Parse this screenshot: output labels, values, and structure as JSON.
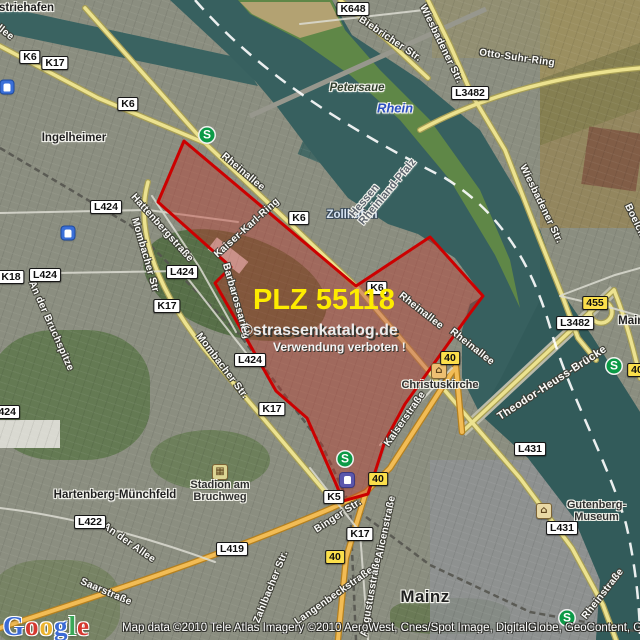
{
  "watermark": {
    "plz_label": "PLZ 55118",
    "brand": "©strassenkatalog.de",
    "warning": "Verwendung verboten !"
  },
  "attribution": {
    "logo_text": "Google",
    "logo_colors": [
      "#3b6ad4",
      "#d5382f",
      "#ecb32c",
      "#3b6ad4",
      "#3aa757",
      "#d5382f"
    ],
    "copyright": "Map data ©2010 Tele Atlas  Imagery ©2010 AeroWest, Cnes/Spot Image, DigitalGlobe, GeoContent, GeoEye"
  },
  "map": {
    "highlight": {
      "plz": "55118",
      "fill": "#be372d",
      "stroke": "#cc0000"
    },
    "colors": {
      "water": "#3a6361",
      "road_major": "#ece28f",
      "road_b": "#f2bc55",
      "island": "#5f8747"
    },
    "place_labels": [
      {
        "text": "ustriehafen",
        "x": 23,
        "y": 8,
        "cls": ""
      },
      {
        "text": "Ingelheimer",
        "x": 74,
        "y": 138,
        "cls": ""
      },
      {
        "text": "Petersaue",
        "x": 357,
        "y": 88,
        "cls": "ital"
      },
      {
        "text": "Rhein",
        "x": 395,
        "y": 108,
        "cls": "water"
      },
      {
        "text": "Zollhafen",
        "x": 352,
        "y": 215,
        "cls": "harbor"
      },
      {
        "text": "Hessen\nRheinland-Pfalz",
        "x": 383,
        "y": 188,
        "cls": "border",
        "rot": -50
      },
      {
        "text": "Hartenberg-Münchfeld",
        "x": 115,
        "y": 495,
        "cls": ""
      },
      {
        "text": "Mainz",
        "x": 425,
        "y": 597,
        "cls": "big"
      },
      {
        "text": "Mainz-",
        "x": 636,
        "y": 321,
        "cls": ""
      }
    ],
    "street_labels": [
      {
        "text": "allee",
        "x": 3,
        "y": 31,
        "rot": 38
      },
      {
        "text": "Rheinallee",
        "x": 243,
        "y": 172,
        "rot": 40
      },
      {
        "text": "Rheinallee",
        "x": 421,
        "y": 311,
        "rot": 38
      },
      {
        "text": "Rheinallee",
        "x": 472,
        "y": 347,
        "rot": 38
      },
      {
        "text": "Rheinstraße",
        "x": 603,
        "y": 594,
        "rot": -52
      },
      {
        "text": "Biebricher Str.",
        "x": 390,
        "y": 39,
        "rot": 34
      },
      {
        "text": "Wiesbadener Str.",
        "x": 441,
        "y": 44,
        "rot": 64
      },
      {
        "text": "Wiesbadener Str.",
        "x": 541,
        "y": 204,
        "rot": 64
      },
      {
        "text": "Otto-Suhr-Ring",
        "x": 517,
        "y": 58,
        "rot": 8
      },
      {
        "text": "Boelckestraße",
        "x": 643,
        "y": 237,
        "rot": 64
      },
      {
        "text": "Kaiser-Karl-Ring",
        "x": 247,
        "y": 228,
        "rot": -42
      },
      {
        "text": "Barbarossaring",
        "x": 236,
        "y": 301,
        "rot": 74
      },
      {
        "text": "Hattenbergstraße",
        "x": 162,
        "y": 228,
        "rot": 48
      },
      {
        "text": "Mombacher Str",
        "x": 145,
        "y": 255,
        "rot": 74
      },
      {
        "text": "Mombacher Str.",
        "x": 222,
        "y": 366,
        "rot": 53
      },
      {
        "text": "An der Bruchspitze",
        "x": 51,
        "y": 326,
        "rot": 66
      },
      {
        "text": "An der Allee",
        "x": 129,
        "y": 543,
        "rot": 35
      },
      {
        "text": "Saarstraße",
        "x": 106,
        "y": 592,
        "rot": 23
      },
      {
        "text": "Zahlbacher Str.",
        "x": 271,
        "y": 587,
        "rot": -68
      },
      {
        "text": "Langenbeckstraße",
        "x": 334,
        "y": 596,
        "rot": -35
      },
      {
        "text": "Augustusstraße",
        "x": 371,
        "y": 597,
        "rot": -80
      },
      {
        "text": "Alicenstraße",
        "x": 386,
        "y": 527,
        "rot": -78
      },
      {
        "text": "Binger Str.",
        "x": 338,
        "y": 516,
        "rot": -33
      },
      {
        "text": "Kaiserstraße",
        "x": 405,
        "y": 419,
        "rot": -55
      },
      {
        "text": "Theodor-Heuss-Brücke",
        "x": 552,
        "y": 383,
        "rot": -33,
        "cls": "bridge"
      }
    ],
    "shields": [
      {
        "text": "K6",
        "x": 30,
        "y": 57
      },
      {
        "text": "K17",
        "x": 55,
        "y": 63
      },
      {
        "text": "K6",
        "x": 128,
        "y": 104
      },
      {
        "text": "K648",
        "x": 353,
        "y": 9
      },
      {
        "text": "L3482",
        "x": 470,
        "y": 93
      },
      {
        "text": "L424",
        "x": 106,
        "y": 207
      },
      {
        "text": "K6",
        "x": 299,
        "y": 218
      },
      {
        "text": "L424",
        "x": 182,
        "y": 272
      },
      {
        "text": "L424",
        "x": 45,
        "y": 275
      },
      {
        "text": "K18",
        "x": 11,
        "y": 277
      },
      {
        "text": "K6",
        "x": 377,
        "y": 288
      },
      {
        "text": "K17",
        "x": 167,
        "y": 306
      },
      {
        "text": "455",
        "x": 595,
        "y": 303,
        "t": "y"
      },
      {
        "text": "L3482",
        "x": 575,
        "y": 323
      },
      {
        "text": "40",
        "x": 450,
        "y": 358,
        "t": "y"
      },
      {
        "text": "40",
        "x": 637,
        "y": 370,
        "t": "y"
      },
      {
        "text": "L424",
        "x": 250,
        "y": 360
      },
      {
        "text": "K17",
        "x": 272,
        "y": 409
      },
      {
        "text": "L424",
        "x": 4,
        "y": 412
      },
      {
        "text": "L431",
        "x": 530,
        "y": 449
      },
      {
        "text": "40",
        "x": 378,
        "y": 479,
        "t": "y"
      },
      {
        "text": "K5",
        "x": 334,
        "y": 497
      },
      {
        "text": "L422",
        "x": 90,
        "y": 522
      },
      {
        "text": "L431",
        "x": 562,
        "y": 528
      },
      {
        "text": "K17",
        "x": 360,
        "y": 534
      },
      {
        "text": "L419",
        "x": 232,
        "y": 549
      },
      {
        "text": "40",
        "x": 335,
        "y": 557,
        "t": "y"
      }
    ],
    "transit": [
      {
        "type": "sbahn",
        "glyph": "S",
        "x": 207,
        "y": 135
      },
      {
        "type": "sbahn",
        "glyph": "S",
        "x": 614,
        "y": 366
      },
      {
        "type": "sbahn",
        "glyph": "S",
        "x": 345,
        "y": 459
      },
      {
        "type": "sbahn",
        "glyph": "S",
        "x": 567,
        "y": 618
      },
      {
        "type": "train",
        "x": 7,
        "y": 87
      },
      {
        "type": "train",
        "x": 68,
        "y": 233
      },
      {
        "type": "station",
        "x": 347,
        "y": 480
      }
    ],
    "pois": [
      {
        "kind": "church",
        "glyph": "⌂",
        "x": 439,
        "y": 371,
        "label": "Christuskirche",
        "lx": 440,
        "ly": 385
      },
      {
        "kind": "stadium",
        "glyph": "▦",
        "x": 220,
        "y": 472,
        "label": "Stadion am\nBruchweg",
        "lx": 220,
        "ly": 491
      },
      {
        "kind": "museum",
        "glyph": "⌂",
        "x": 544,
        "y": 511,
        "label": "Gutenberg-Museum",
        "lx": 598,
        "ly": 511
      }
    ]
  }
}
